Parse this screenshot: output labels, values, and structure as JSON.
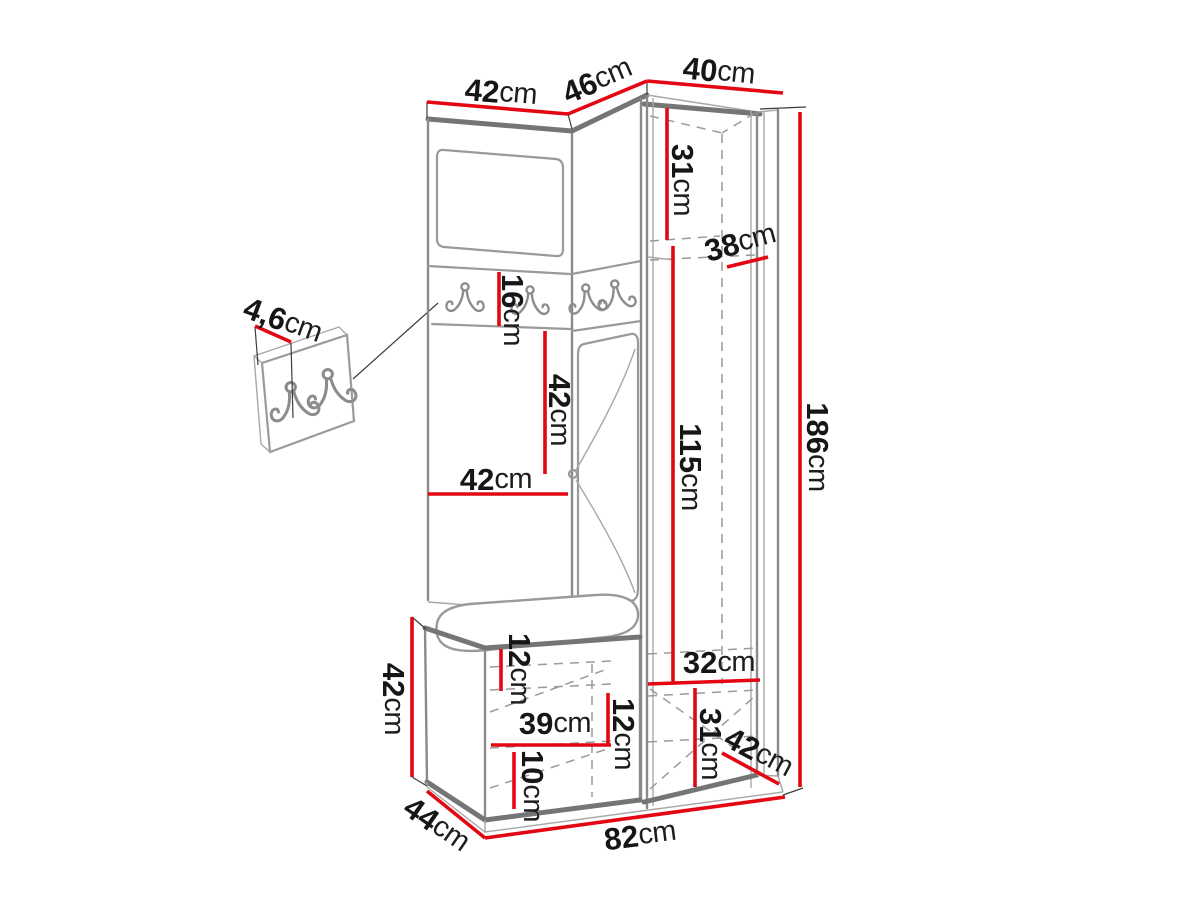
{
  "diagram": {
    "kind": "furniture-dimension-drawing",
    "accent_color": "#e30613",
    "outline_color": "#757575"
  },
  "dims": {
    "top_left_width": {
      "value": "42",
      "unit": "cm"
    },
    "top_middle_width": {
      "value": "46",
      "unit": "cm"
    },
    "top_right_width": {
      "value": "40",
      "unit": "cm"
    },
    "upper_inner_height": {
      "value": "31",
      "unit": "cm"
    },
    "upper_depth": {
      "value": "38",
      "unit": "cm"
    },
    "panel_thickness": {
      "value": "4,6",
      "unit": "cm"
    },
    "hook_panel_height": {
      "value": "16",
      "unit": "cm"
    },
    "padded_panel_height": {
      "value": "42",
      "unit": "cm"
    },
    "left_section_width": {
      "value": "42",
      "unit": "cm"
    },
    "wardrobe_inner_height": {
      "value": "115",
      "unit": "cm"
    },
    "total_height": {
      "value": "186",
      "unit": "cm"
    },
    "bench_height": {
      "value": "42",
      "unit": "cm"
    },
    "bench_top_inset": {
      "value": "12",
      "unit": "cm"
    },
    "bench_inner_width": {
      "value": "39",
      "unit": "cm"
    },
    "bench_shelf_spacing": {
      "value": "12",
      "unit": "cm"
    },
    "bench_bottom_inset": {
      "value": "10",
      "unit": "cm"
    },
    "lower_inner_width": {
      "value": "32",
      "unit": "cm"
    },
    "lower_inner_height": {
      "value": "31",
      "unit": "cm"
    },
    "side_depth": {
      "value": "42",
      "unit": "cm"
    },
    "bench_depth": {
      "value": "44",
      "unit": "cm"
    },
    "total_width": {
      "value": "82",
      "unit": "cm"
    }
  }
}
